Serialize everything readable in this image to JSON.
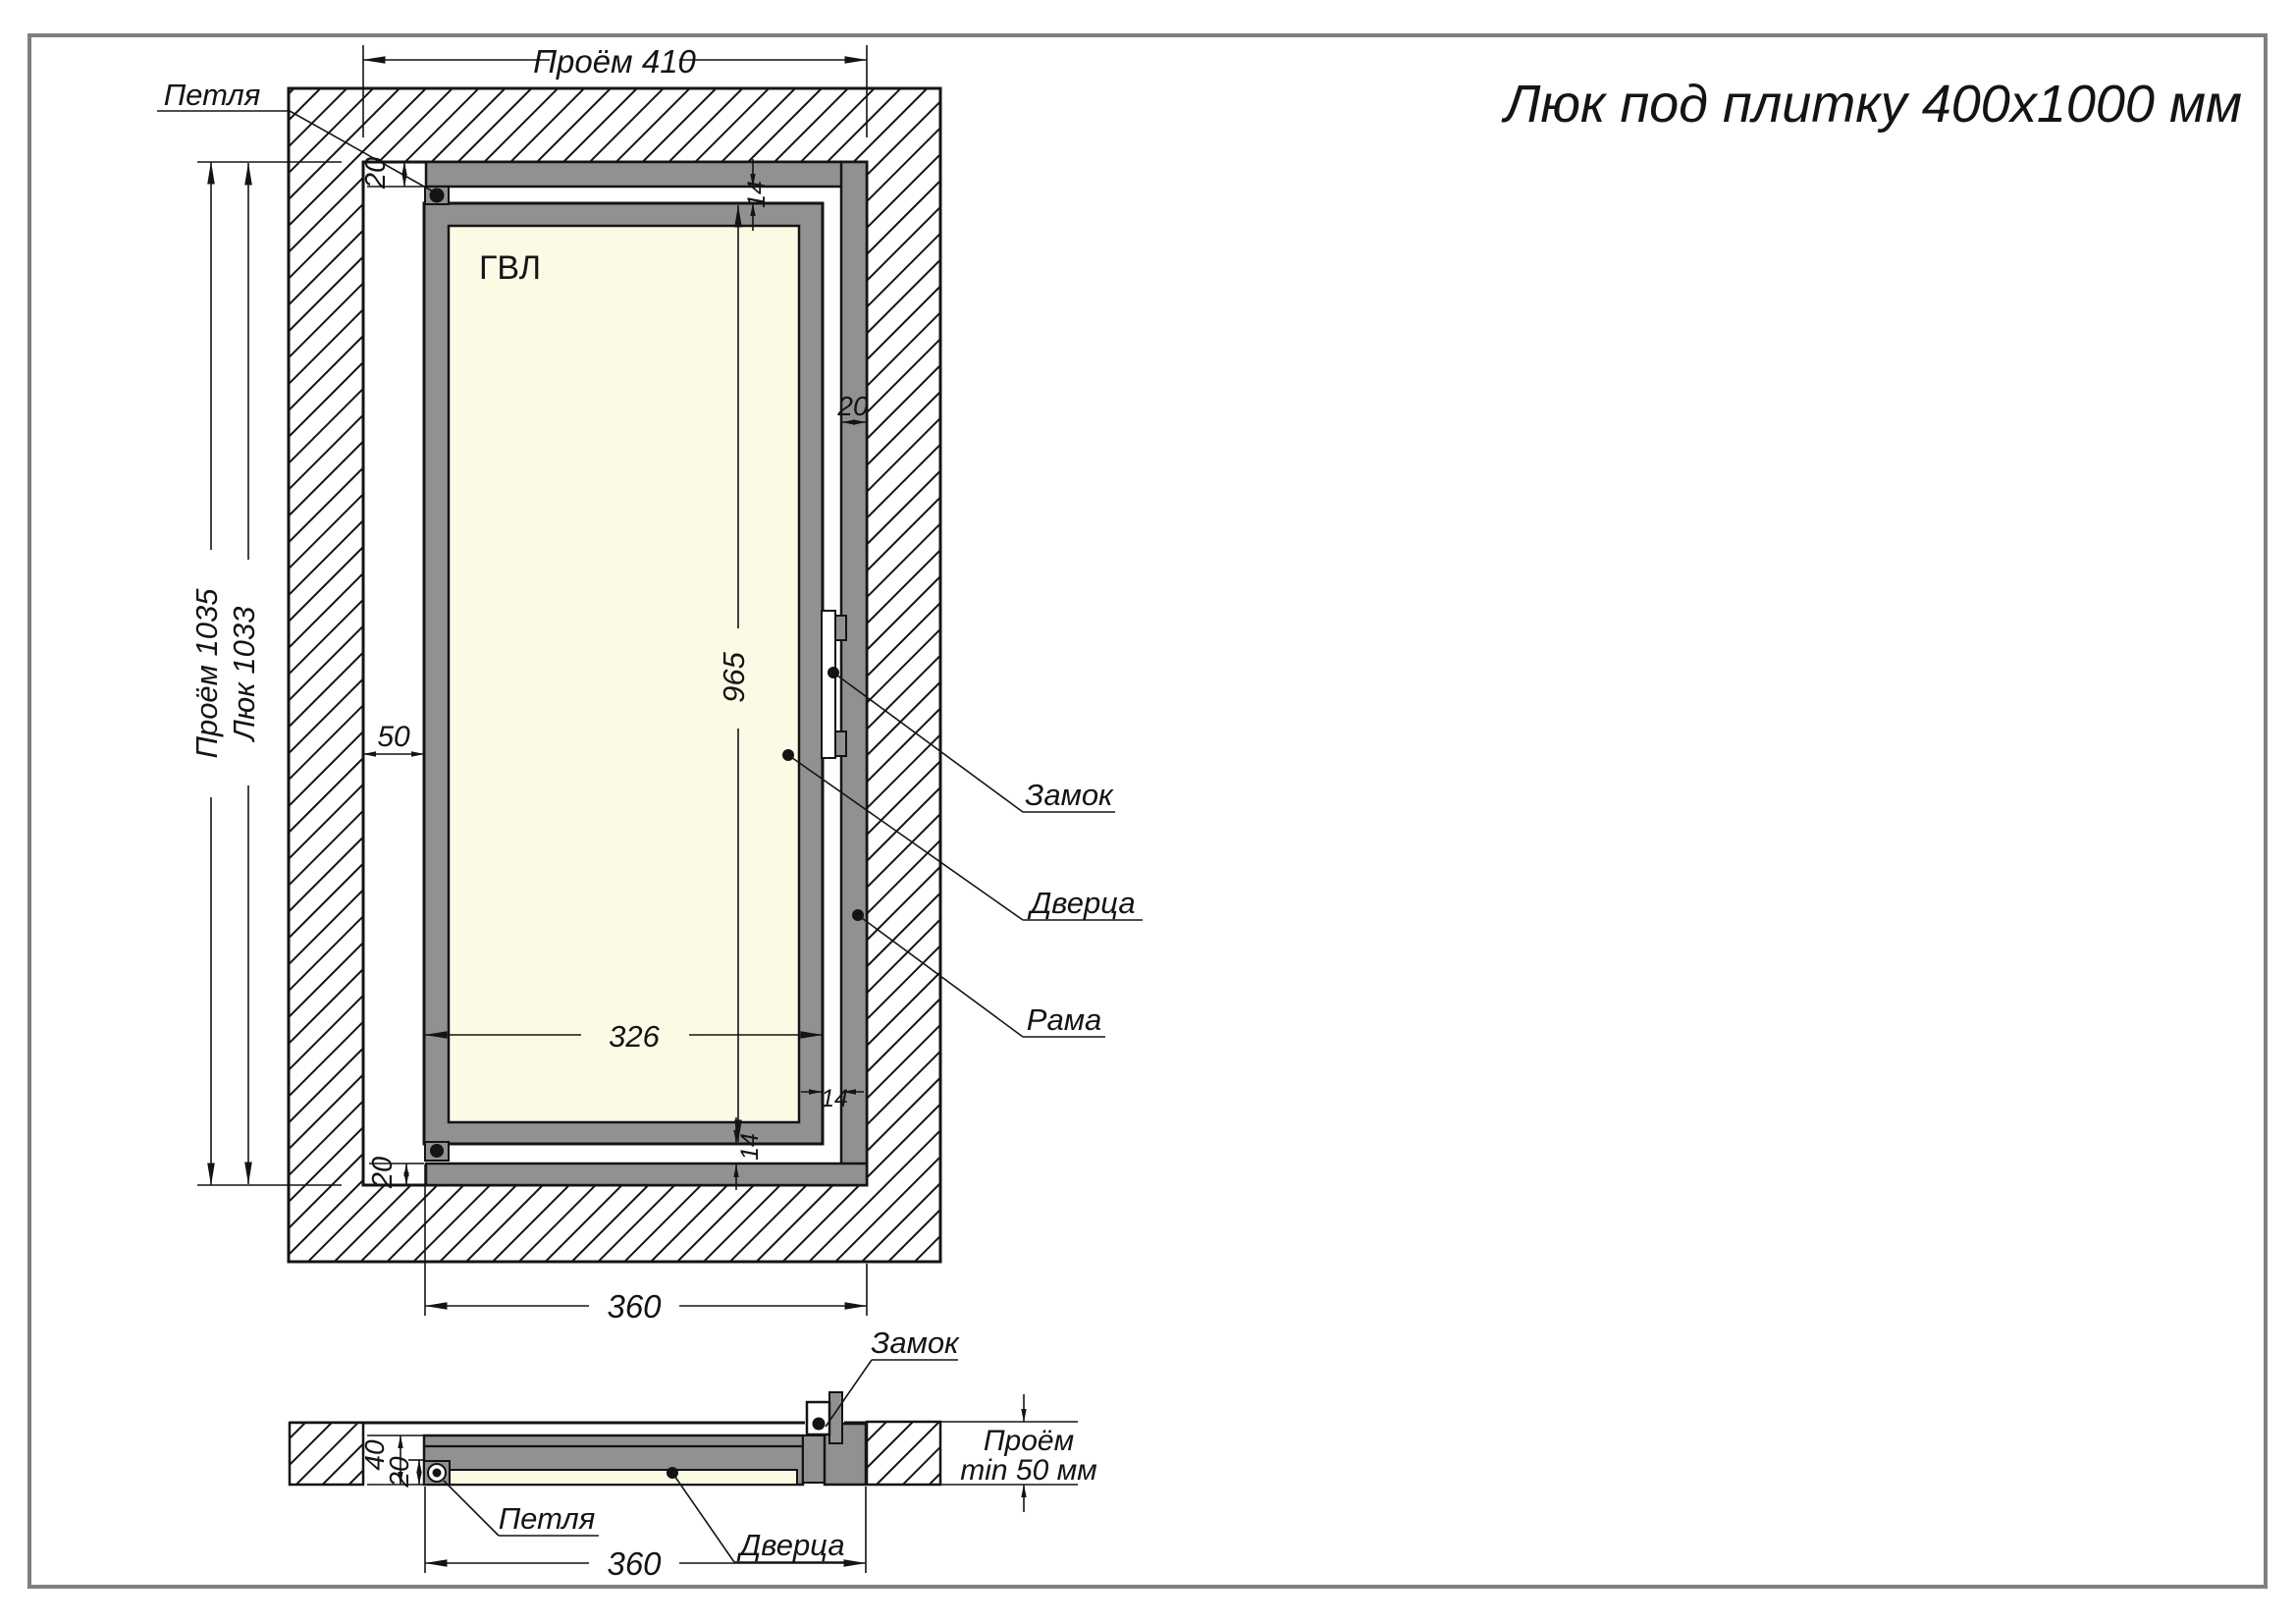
{
  "title": "Люк под плитку 400х1000 мм",
  "front": {
    "labels": {
      "hinge": "Петля",
      "lock": "Замок",
      "door": "Дверца",
      "frame": "Рама",
      "panel": "ГВЛ"
    },
    "dims": {
      "opening_width": "Проём 410",
      "opening_height": "Проём 1035",
      "hatch_height": "Люк 1033",
      "side_gap": "50",
      "frame_top": "20",
      "top_gap": "14",
      "frame_right": "20",
      "door_height": "965",
      "door_width": "326",
      "bottom_gap": "14",
      "right_gap": "14",
      "frame_bottom": "20",
      "outer_width": "360"
    }
  },
  "section": {
    "labels": {
      "lock": "Замок",
      "hinge": "Петля",
      "door": "Дверца"
    },
    "dims": {
      "thickness": "40",
      "panel": "20",
      "outer_width": "360",
      "depth_label": "Проём",
      "depth_value": "min 50 мм"
    }
  },
  "colors": {
    "steel": "#919191",
    "panel": "#fbfae5",
    "line": "#141414",
    "page_border": "#7f7f7f"
  }
}
